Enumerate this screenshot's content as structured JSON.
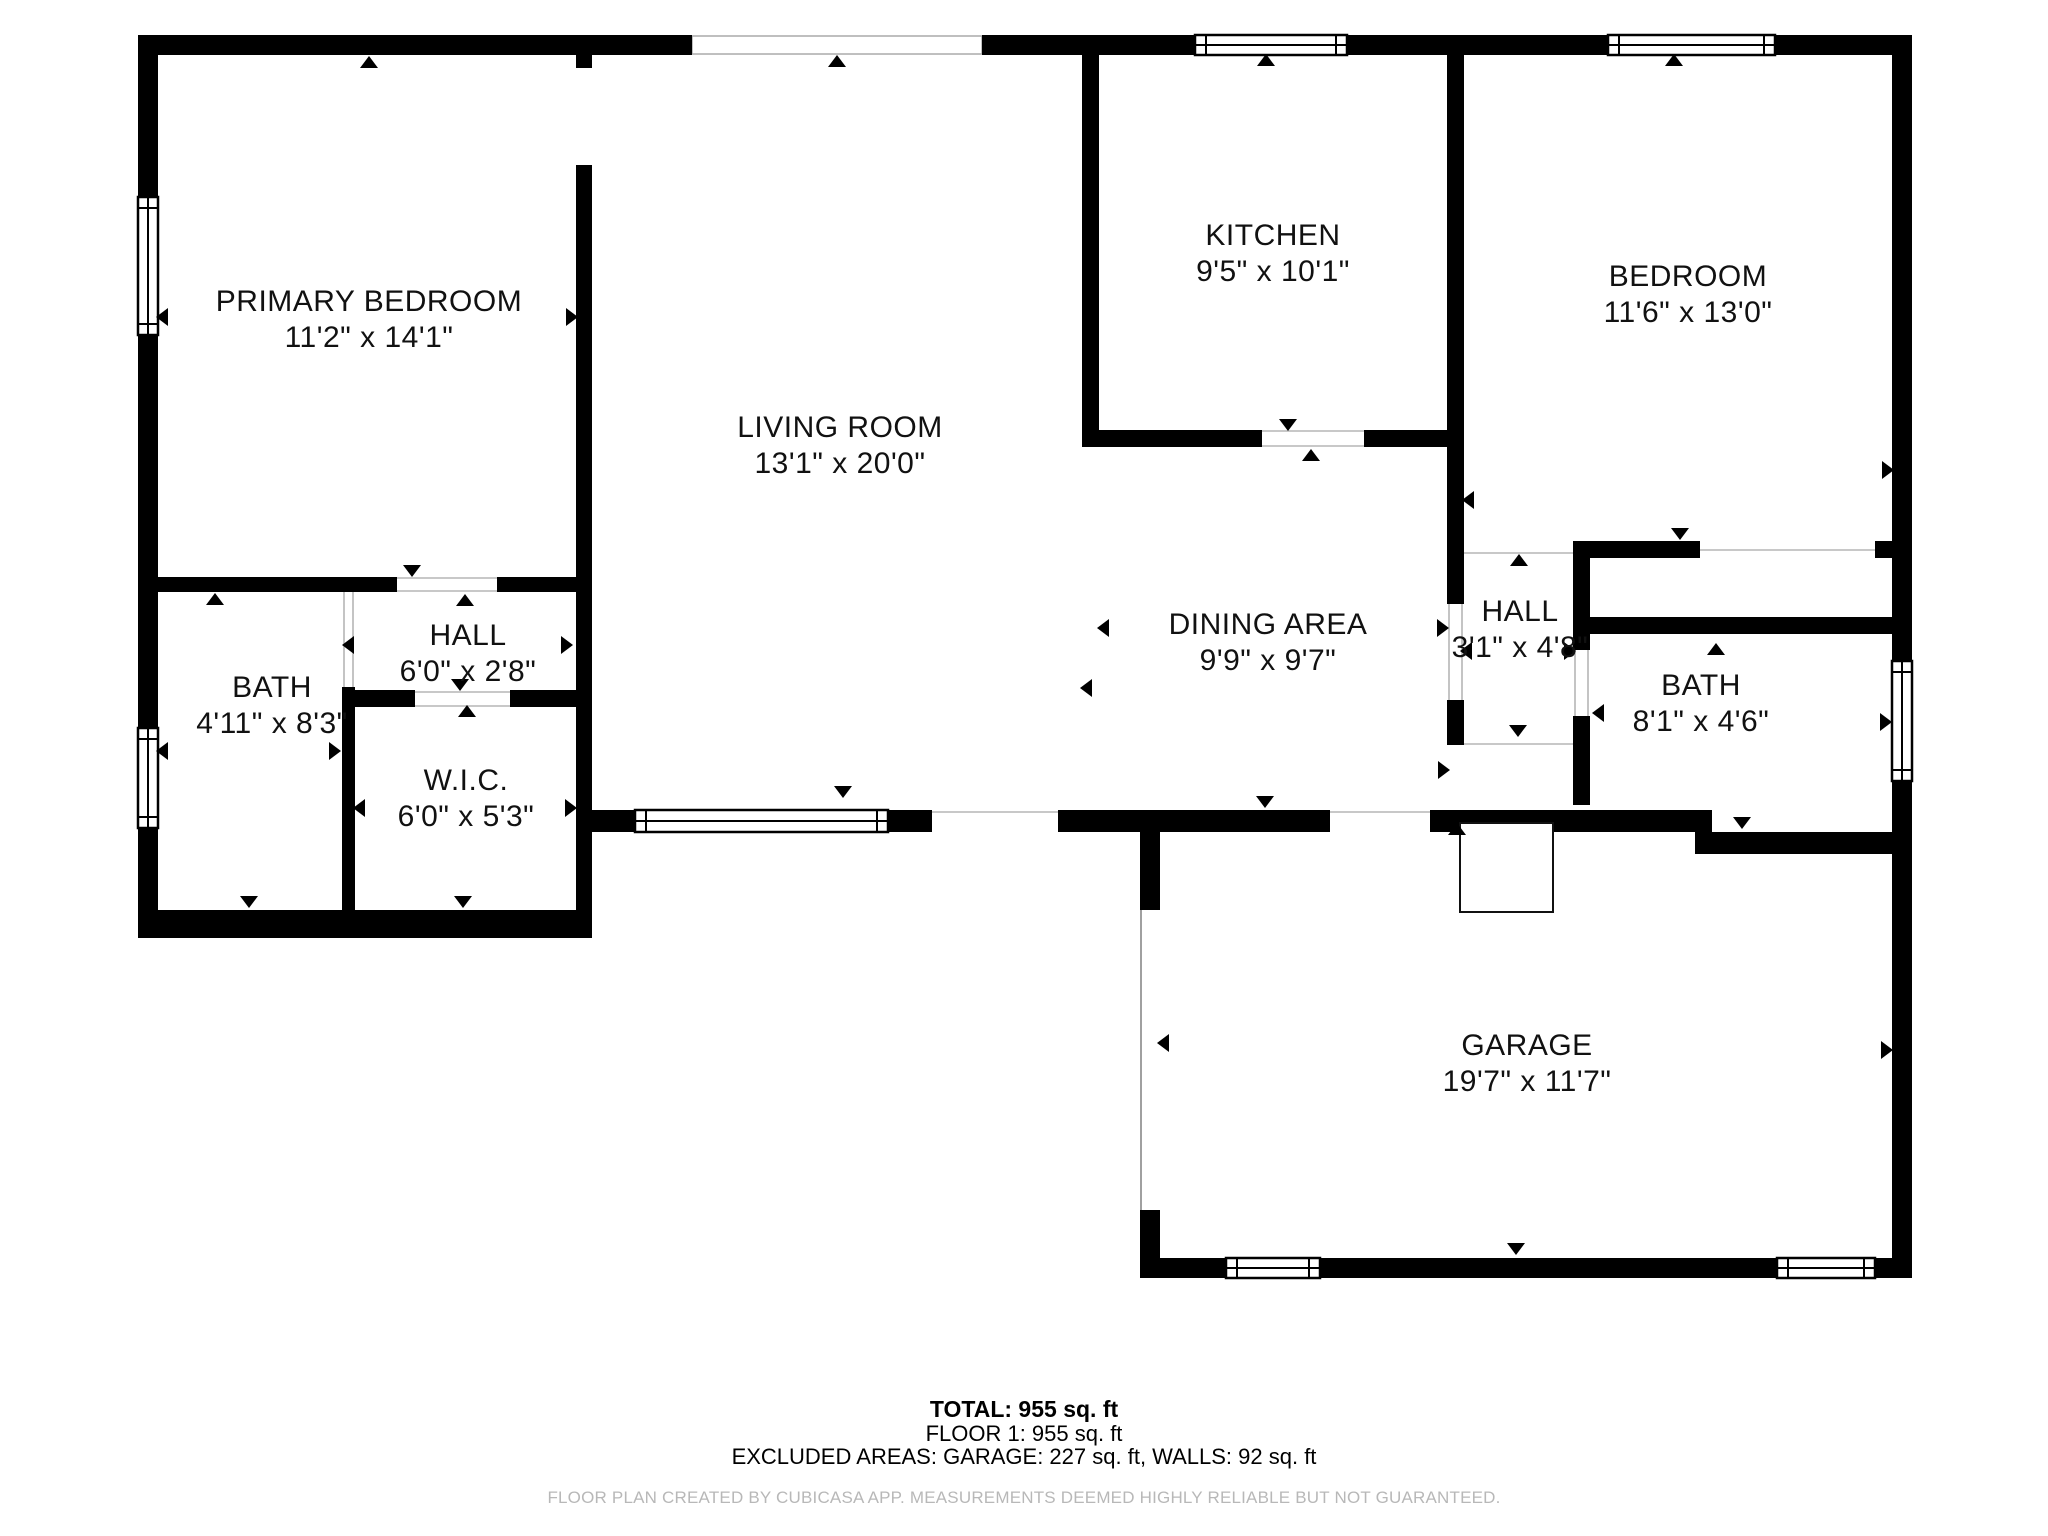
{
  "floor_plan": {
    "title": "CubiCasa floor plan",
    "colors": {
      "wall": "#000000",
      "background": "#ffffff",
      "label": "#111111",
      "thin_line": "#b5b5b5",
      "disclaimer_text": "#b8b8b8"
    },
    "rooms": [
      {
        "id": "primary-bedroom",
        "name": "PRIMARY BEDROOM",
        "dims": "11'2\" x 14'1\"",
        "cx": 369,
        "cy": 316
      },
      {
        "id": "living-room",
        "name": "LIVING ROOM",
        "dims": "13'1\" x 20'0\"",
        "cx": 840,
        "cy": 442
      },
      {
        "id": "kitchen",
        "name": "KITCHEN",
        "dims": "9'5\" x 10'1\"",
        "cx": 1273,
        "cy": 250
      },
      {
        "id": "bedroom",
        "name": "BEDROOM",
        "dims": "11'6\" x 13'0\"",
        "cx": 1688,
        "cy": 291
      },
      {
        "id": "bath-1",
        "name": "BATH",
        "dims": "4'11\" x 8'3\"",
        "cx": 272,
        "cy": 702
      },
      {
        "id": "hall-1",
        "name": "HALL",
        "dims": "6'0\" x 2'8\"",
        "cx": 468,
        "cy": 650
      },
      {
        "id": "wic",
        "name": "W.I.C.",
        "dims": "6'0\" x 5'3\"",
        "cx": 466,
        "cy": 795
      },
      {
        "id": "dining-area",
        "name": "DINING AREA",
        "dims": "9'9\" x 9'7\"",
        "cx": 1268,
        "cy": 639
      },
      {
        "id": "hall-2",
        "name": "HALL",
        "dims": "3'1\" x 4'8\"",
        "cx": 1520,
        "cy": 626
      },
      {
        "id": "bath-2",
        "name": "BATH",
        "dims": "8'1\" x 4'6\"",
        "cx": 1701,
        "cy": 700
      },
      {
        "id": "garage",
        "name": "GARAGE",
        "dims": "19'7\" x 11'7\"",
        "cx": 1527,
        "cy": 1060
      }
    ],
    "footer": {
      "total": "TOTAL: 955 sq. ft",
      "floor": "FLOOR 1: 955 sq. ft",
      "excluded": "EXCLUDED AREAS: GARAGE: 227 sq. ft, WALLS: 92 sq. ft",
      "disclaimer": "FLOOR PLAN CREATED BY CUBICASA APP. MEASUREMENTS DEEMED HIGHLY RELIABLE BUT NOT GUARANTEED."
    }
  }
}
